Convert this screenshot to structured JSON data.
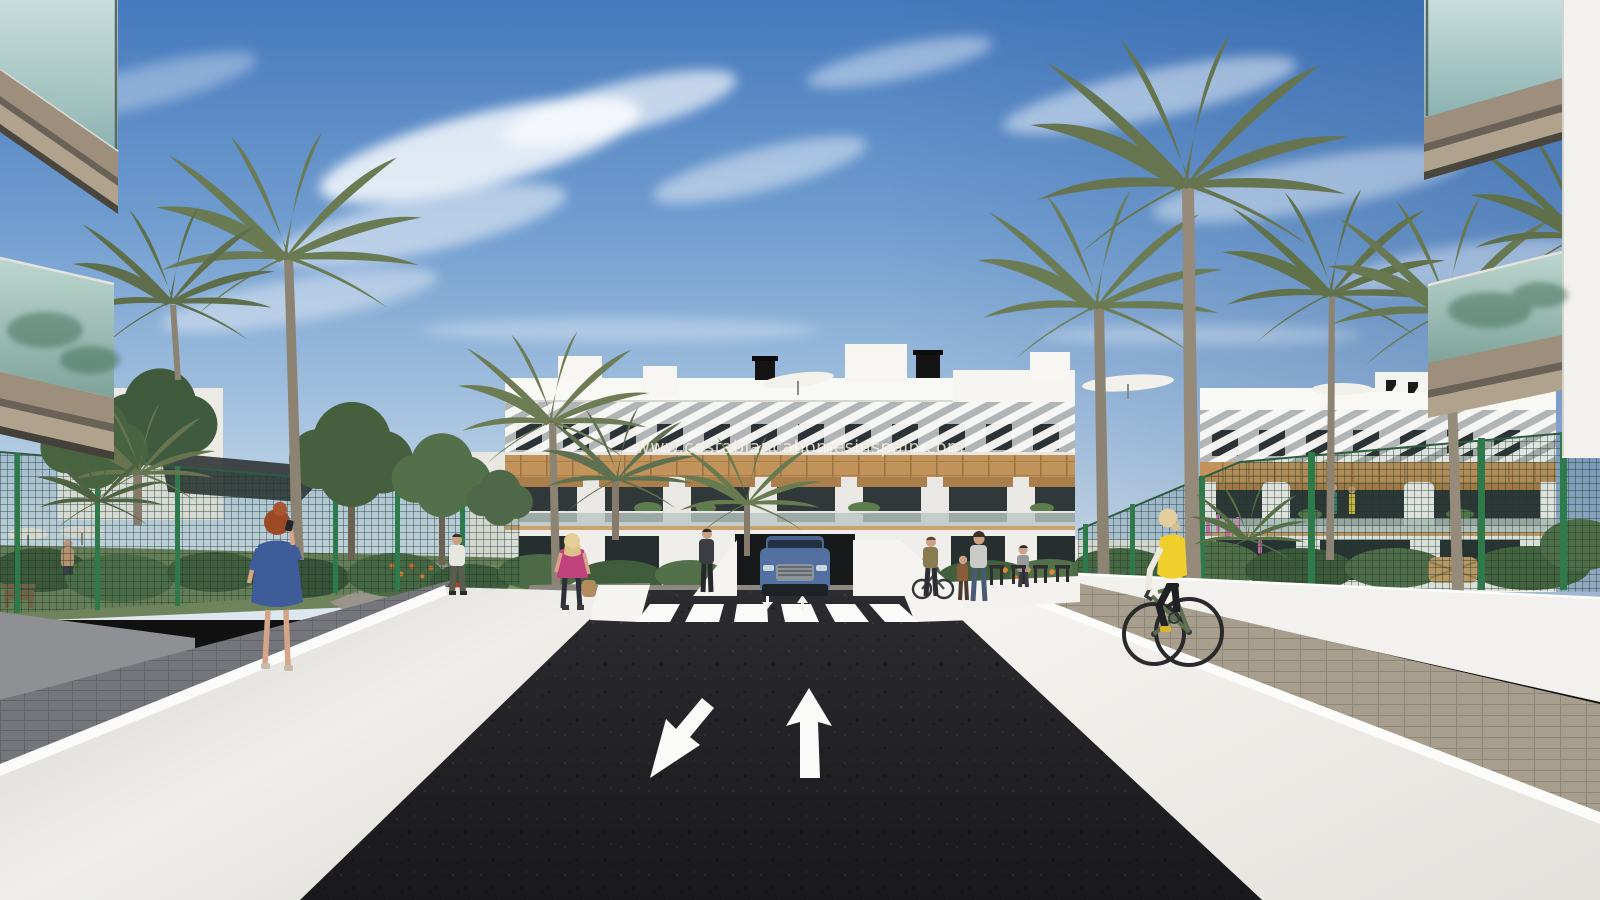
{
  "page": {
    "title": "Residential development exterior 3D render"
  },
  "watermark": {
    "text": "www.costablancahomesinspain.com"
  },
  "scene": {
    "description": "3D architectural rendering of a modern white Mediterranean apartment complex with palm trees, a private asphalt road with zebra crosswalk and painted direction arrows, pedestrians, a cyclist in a yellow vest, and a blue SUV exiting an underground garage",
    "objects": [
      "blue sky with wispy clouds",
      "white apartment building with wood cladding, pergola slats and rooftop parasols",
      "second apartment block behind palms",
      "tall palm trees",
      "dark green mesh garden fences",
      "dark asphalt road",
      "zebra crosswalk",
      "road direction arrows",
      "blue SUV at garage ramp",
      "woman in blue dress on phone",
      "woman in pink top with handbag",
      "pedestrians near bike racks",
      "cyclist in yellow vest",
      "garden vegetation with orange and pink flowers",
      "white perimeter walls and paver walkways",
      "foreground balconies with glass railings"
    ]
  },
  "road_markings": {
    "crosswalk_stripe_count": 6,
    "large_arrows": [
      {
        "direction": "down-left"
      },
      {
        "direction": "up"
      }
    ],
    "small_arrows": [
      {
        "direction": "down"
      },
      {
        "direction": "up"
      }
    ]
  },
  "colors": {
    "sky_top": "#4579bd",
    "sky_horizon": "#dde8f1",
    "building_white": "#f1f0ec",
    "wood_cladding": "#c2945c",
    "window_glass": "#2c3336",
    "fence_green": "#2f7a4a",
    "asphalt": "#232327",
    "marking_white": "#fafaf8",
    "car_blue": "#51709f",
    "vest_yellow": "#f0cf2c",
    "dress_blue": "#3f5c9a",
    "pink_top": "#c0417b",
    "palm_green": "#66754f",
    "watermark_color": "rgba(255,252,243,0.75)"
  }
}
